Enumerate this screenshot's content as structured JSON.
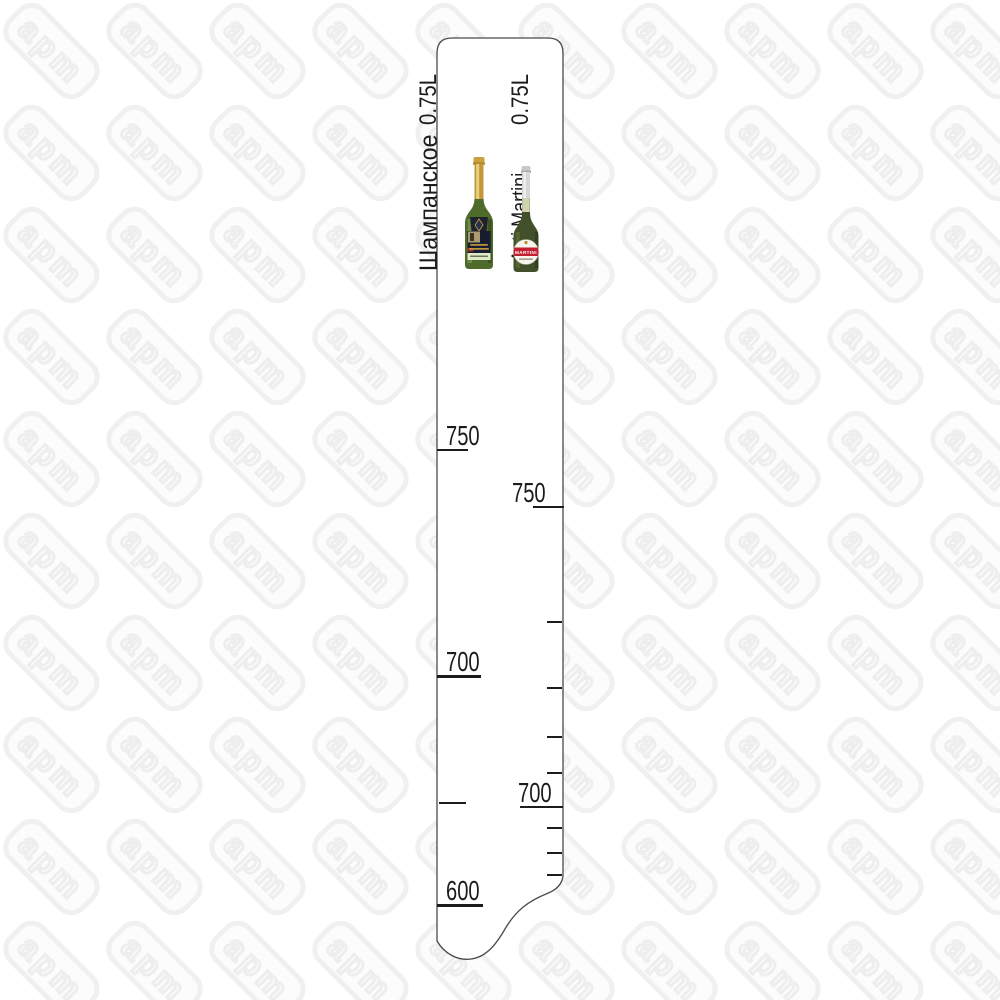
{
  "watermark": {
    "text": "apm"
  },
  "ruler": {
    "left_product": {
      "name": "Шампанское",
      "volume": "0.75L"
    },
    "right_product": {
      "name": "Asti Martini",
      "volume": "0.75L",
      "bottle_label": "MARTINI"
    },
    "left_scale_ticks": [
      {
        "label": "750",
        "y": 450,
        "x": 437,
        "len": 31,
        "w": 2.5,
        "label_x": 446
      },
      {
        "label": "700",
        "y": 676,
        "x": 437,
        "len": 44,
        "w": 3,
        "label_x": 446
      },
      {
        "y": 803,
        "x": 439,
        "len": 27,
        "w": 2
      },
      {
        "label": "600",
        "y": 905,
        "x": 437,
        "len": 46,
        "w": 3,
        "label_x": 446
      }
    ],
    "right_scale_ticks": [
      {
        "label": "750",
        "y": 507,
        "x": 533,
        "len": 31,
        "w": 2.5,
        "label_x": 512
      },
      {
        "y": 622,
        "x": 547,
        "len": 15,
        "w": 2
      },
      {
        "y": 688,
        "x": 547,
        "len": 15,
        "w": 2
      },
      {
        "y": 737,
        "x": 547,
        "len": 15,
        "w": 2
      },
      {
        "y": 773,
        "x": 547,
        "len": 15,
        "w": 2
      },
      {
        "label": "700",
        "y": 807,
        "x": 520,
        "len": 43,
        "w": 2.5,
        "label_x": 518
      },
      {
        "y": 828,
        "x": 547,
        "len": 15,
        "w": 2
      },
      {
        "y": 853,
        "x": 547,
        "len": 15,
        "w": 2
      },
      {
        "y": 875,
        "x": 547,
        "len": 15,
        "w": 2
      }
    ]
  },
  "colors": {
    "outline": "#4a4a4a",
    "scale_text": "#1c1c1c",
    "watermark": "#f0f0f0",
    "champagne_foil": "#c9a23f",
    "champagne_glass": "#4e6b2c",
    "asti_foil": "#d6d6d6",
    "asti_glass": "#41502a",
    "martini_red": "#c22030"
  }
}
